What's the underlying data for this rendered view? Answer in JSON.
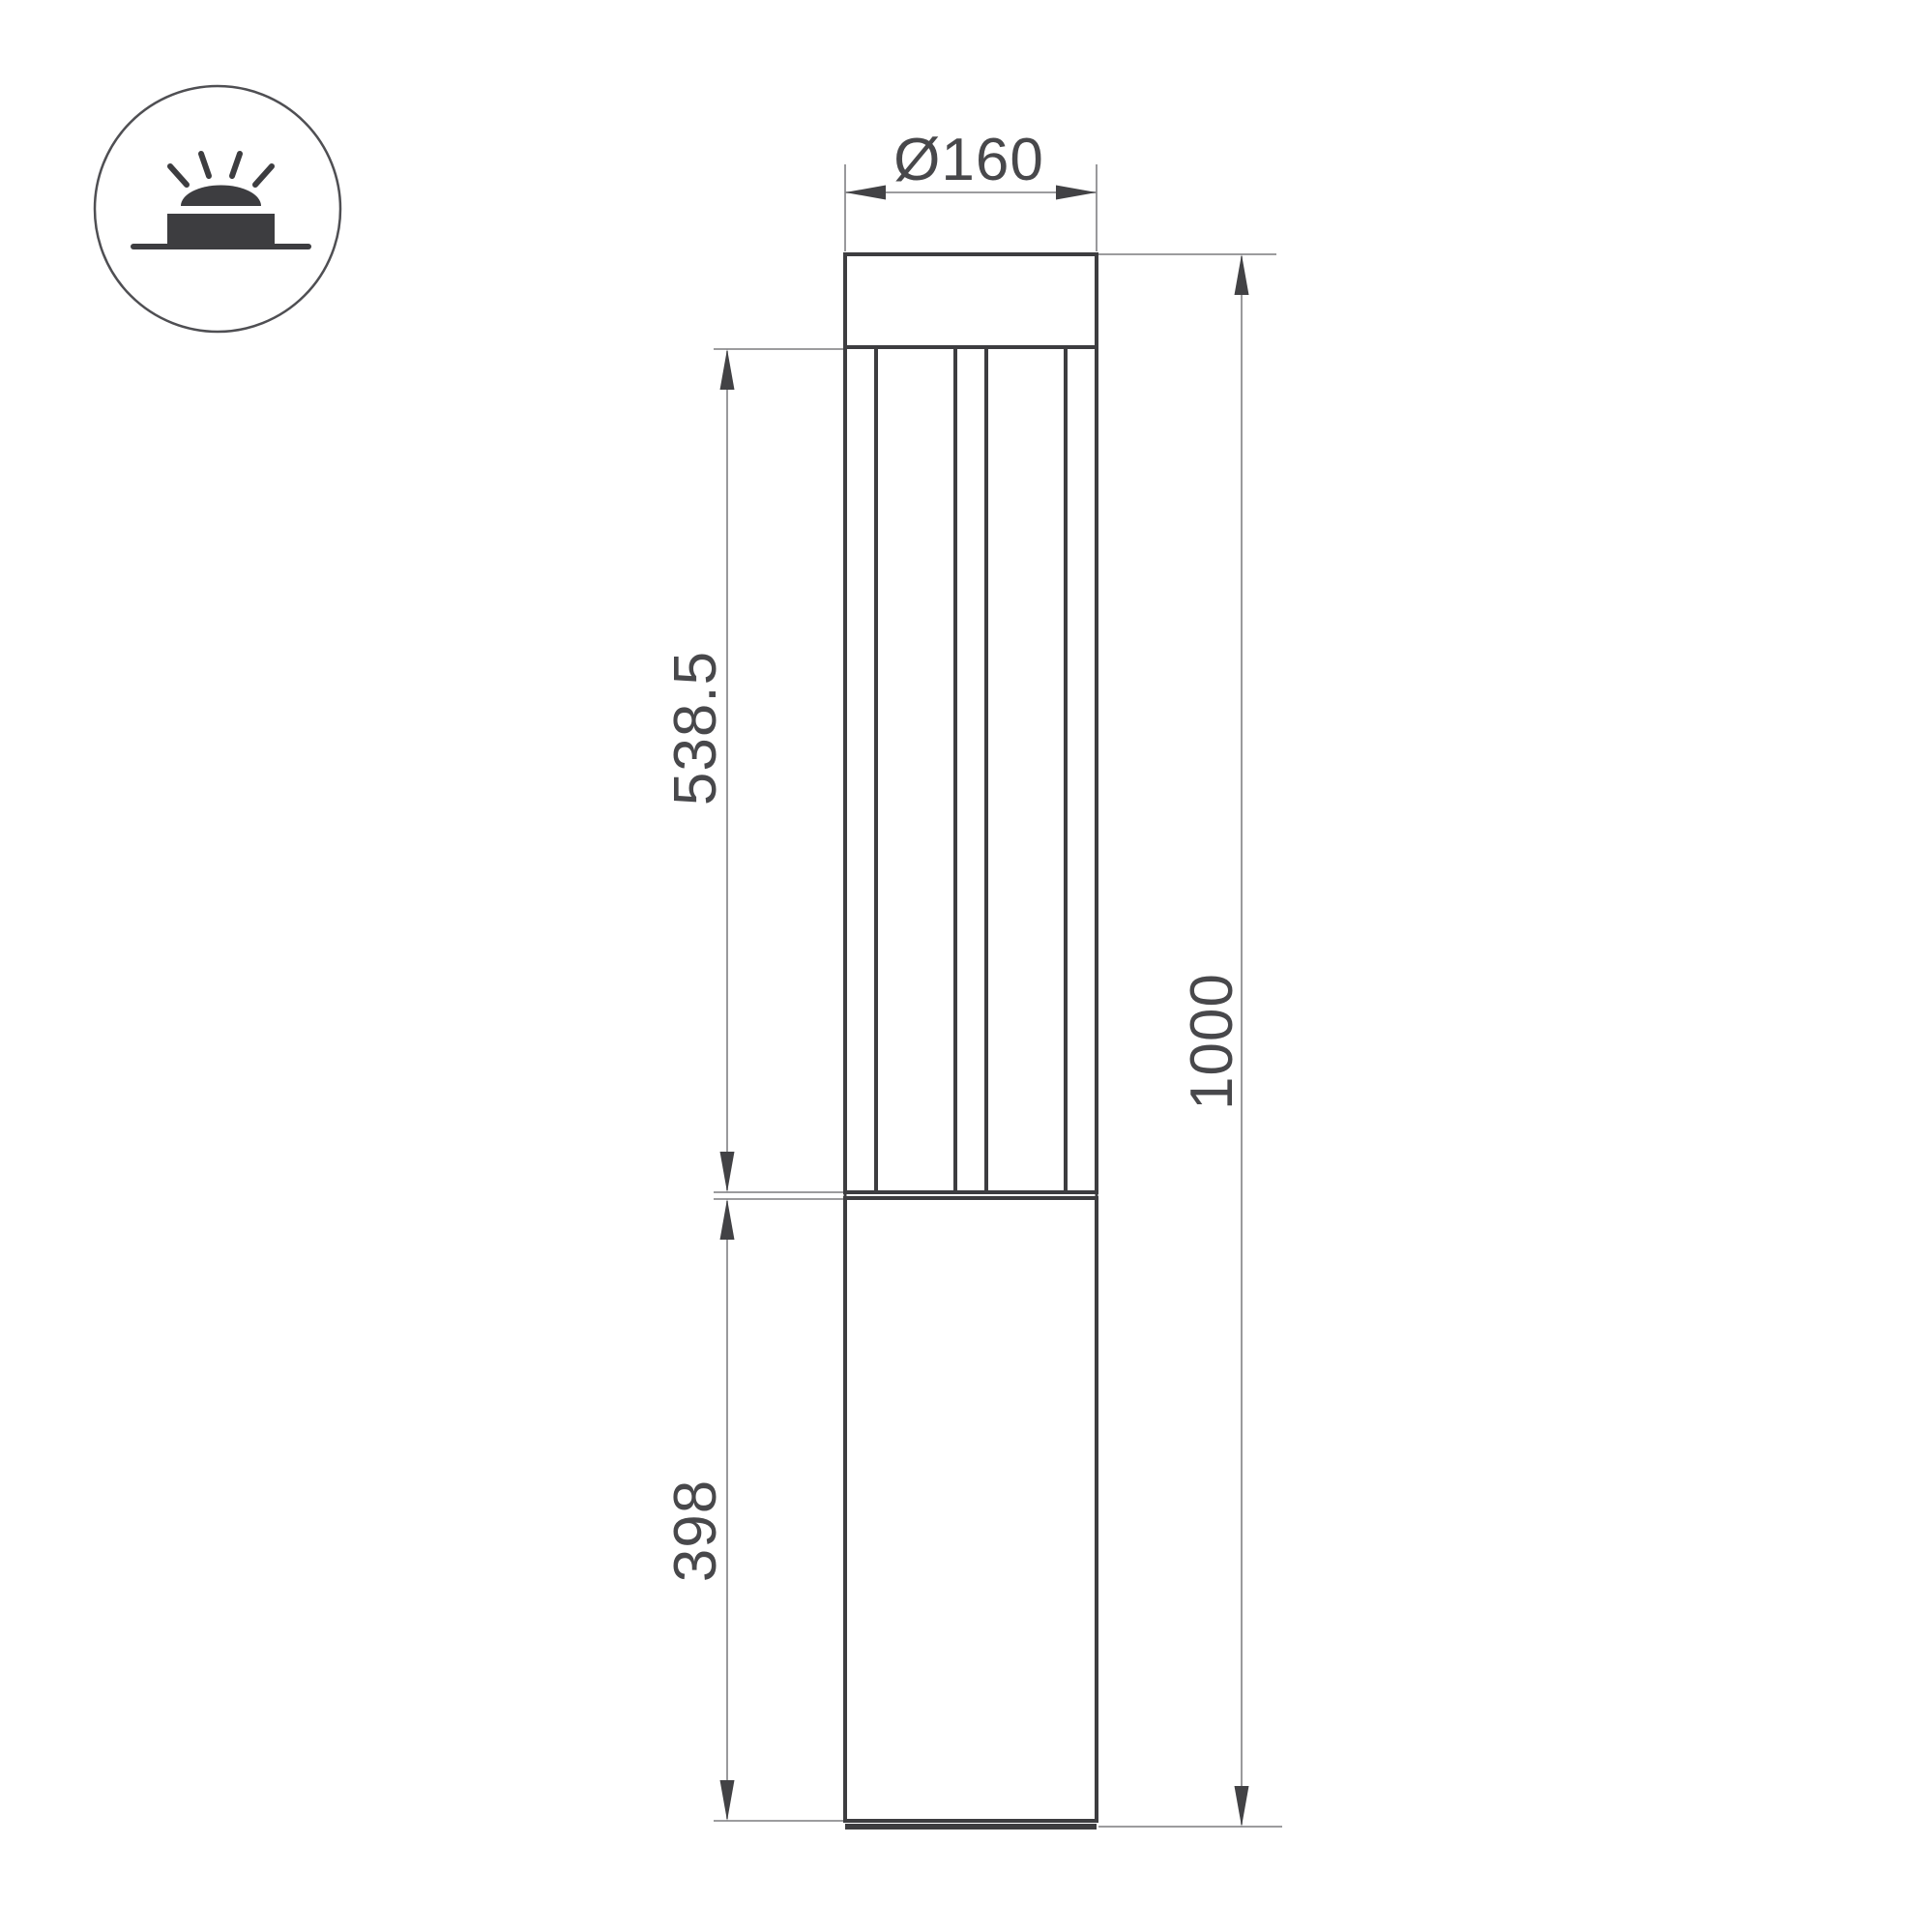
{
  "drawing": {
    "dimensions": {
      "diameter": "Ø160",
      "upper_section": "538.5",
      "lower_section": "398",
      "total_height": "1000"
    },
    "icon": {
      "name": "surface-mounted-light",
      "description": "dome luminaire on a base over ground line with four light rays"
    },
    "colors": {
      "background": "#ffffff",
      "outline": "#3d3d40",
      "dimension_line": "#8e8e91",
      "arrow": "#424245",
      "text": "#48484b",
      "badge_border": "#4f4f53",
      "icon_fill": "#3d3d40"
    }
  }
}
